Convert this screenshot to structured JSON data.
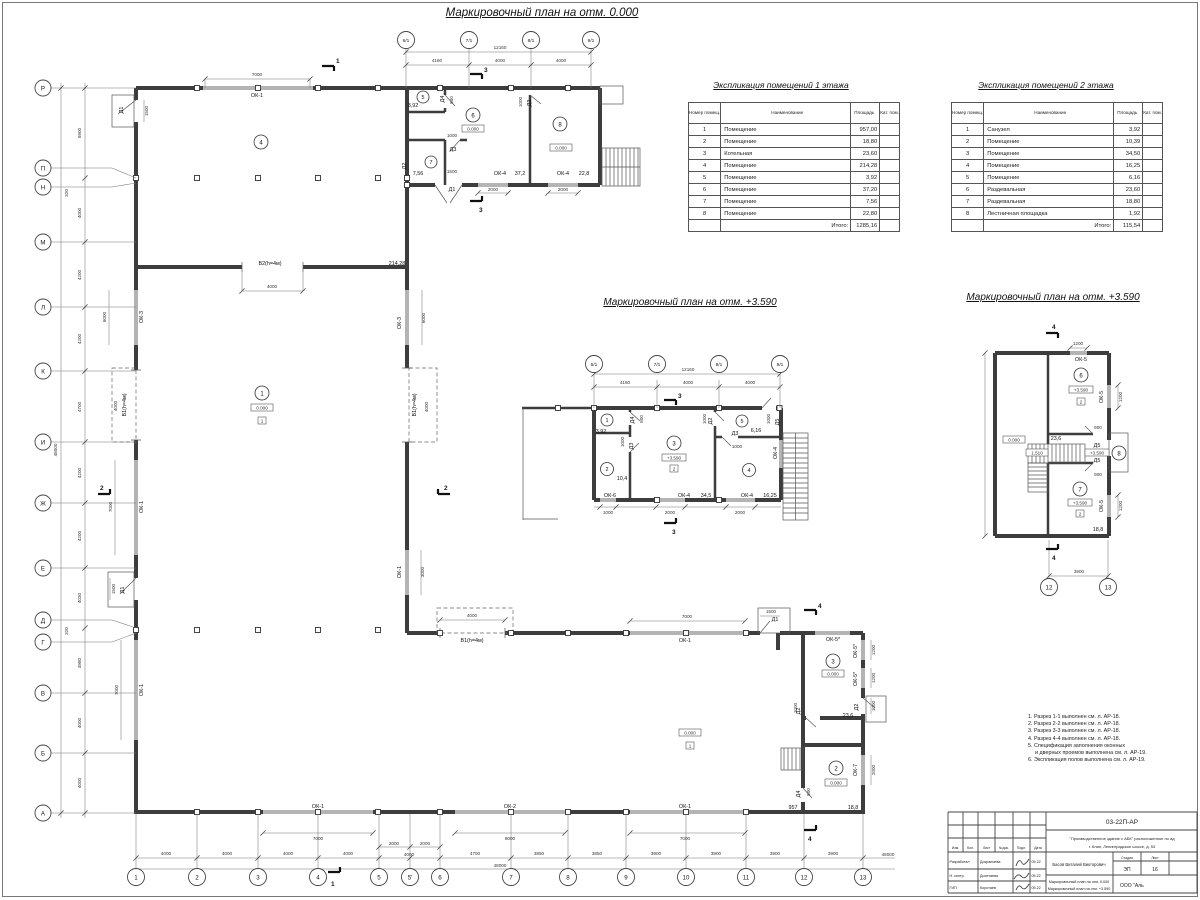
{
  "titles": {
    "plan0": "Маркировочный план на отм. 0.000",
    "plan359": "Маркировочный план на отм. +3.590"
  },
  "tables": {
    "floor1": {
      "title": "Экспликация помещений 1 этажа",
      "h_num": "Номер помещ.",
      "h_name": "Наименование",
      "h_area": "Площадь",
      "h_cat": "Кат. пом.",
      "rows": [
        {
          "n": "1",
          "name": "Помещение",
          "a": "957,00"
        },
        {
          "n": "2",
          "name": "Помещение",
          "a": "18,80"
        },
        {
          "n": "3",
          "name": "Котельная",
          "a": "23,60"
        },
        {
          "n": "4",
          "name": "Помещение",
          "a": "214,28"
        },
        {
          "n": "5",
          "name": "Помещение",
          "a": "3,92"
        },
        {
          "n": "6",
          "name": "Помещение",
          "a": "37,20"
        },
        {
          "n": "7",
          "name": "Помещение",
          "a": "7,56"
        },
        {
          "n": "8",
          "name": "Помещение",
          "a": "22,80"
        }
      ],
      "total_label": "Итого:",
      "total": "1285,16"
    },
    "floor2": {
      "title": "Экспликация помещений 2 этажа",
      "h_num": "Номер помещ.",
      "h_name": "Наименование",
      "h_area": "Площадь",
      "h_cat": "Кат. пом.",
      "rows": [
        {
          "n": "1",
          "name": "Санузел",
          "a": "3,92"
        },
        {
          "n": "2",
          "name": "Помещение",
          "a": "10,39"
        },
        {
          "n": "3",
          "name": "Помещение",
          "a": "34,50"
        },
        {
          "n": "4",
          "name": "Помещение",
          "a": "16,25"
        },
        {
          "n": "5",
          "name": "Помещение",
          "a": "6,16"
        },
        {
          "n": "6",
          "name": "Раздевальная",
          "a": "23,60"
        },
        {
          "n": "7",
          "name": "Раздевальная",
          "a": "18,80"
        },
        {
          "n": "8",
          "name": "Лестничная площадка",
          "a": "1,92"
        }
      ],
      "total_label": "Итого:",
      "total": "115,54"
    }
  },
  "notes": [
    "1. Разрез 1-1 выполнен см. л. АР-18.",
    "2. Разрез 2-2 выполнен см. л. АР-18.",
    "3. Разрез 3-3 выполнен см. л. АР-18.",
    "4. Разрез 4-4 выполнен см. л. АР-18.",
    "5. Спецификация заполнения оконных",
    "и дверных проемов выполнена см. л. АР-19.",
    "6. Экспликация полов выполнена см. л. АР-19."
  ],
  "stamp": {
    "code": "03-22П-АР",
    "object1": "\"Производственное здание с АБК\" расположенное по ад",
    "object2": "г. Клин, Ленинградское шоссе, д. 53",
    "c_izm": "Изм.",
    "c_kol": "Кол.",
    "c_list": "Лист",
    "c_ndok": "№док.",
    "c_podp": "Подл.",
    "c_data": "Дата",
    "r1_role": "Разработал",
    "r1_name": "Докраниева",
    "r1_date": "05.22",
    "r2_role": "Н. контр.",
    "r2_name": "Досетаева",
    "r2_date": "05.22",
    "r3_role": "ГИП",
    "r3_name": "Коротаев",
    "r3_date": "05.22",
    "gip_name": "Басов Виталий Викторович",
    "stage_l": "Стадия",
    "list_l": "Лист",
    "stage": "ЭП",
    "list": "16",
    "t1": "Маркировочный план на отм. 0.000",
    "t2": "Маркировочный план на отм. +3.590",
    "company": "ООО \"Аль"
  },
  "axes": {
    "left": [
      "Р",
      "П",
      "Н",
      "М",
      "Л",
      "К",
      "И",
      "Ж",
      "Е",
      "Д",
      "Г",
      "В",
      "Б",
      "А"
    ],
    "bottom": [
      "1",
      "2",
      "3",
      "4",
      "5",
      "5'",
      "6",
      "7",
      "8",
      "9",
      "10",
      "11",
      "12",
      "13"
    ],
    "top": [
      "6/1",
      "7/1",
      "8/1",
      "9/1"
    ],
    "rp": [
      "12",
      "13"
    ]
  },
  "dims": {
    "n320": "320",
    "n800": "800",
    "n900": "900",
    "n957": "957",
    "n1000": "1000",
    "n1200": "1200",
    "n1500": "1500",
    "n1510": "1,510",
    "n2000": "2000",
    "n3000": "3000",
    "n3850": "3850",
    "n3900": "3900",
    "n3980": "3980",
    "n4000": "4000",
    "n4030": "4030",
    "n4160": "4160",
    "n4200": "4200",
    "n4700": "4700",
    "n5900": "5900",
    "n6000": "6000",
    "n7000": "7000",
    "n8000": "8000",
    "n12160": "12160",
    "n48000": "48000"
  },
  "labels": {
    "ok1": "ОК-1",
    "ok2": "ОК-2",
    "ok3": "ОК-3",
    "ok4": "ОК-4",
    "ok5": "ОК-5",
    "ok5s": "ОК-5*",
    "ok6": "ОК-6",
    "ok7": "ОК-7",
    "d1": "Д1",
    "d2": "Д2",
    "d3": "Д3",
    "d4": "Д4",
    "d5": "Д5",
    "v1": "В1(h=4м)",
    "v2": "В2(h=4м)",
    "lvl0": "0.000",
    "lvl359": "+3.590",
    "fl1": "1",
    "fl2": "2",
    "r1": "1",
    "r2": "2",
    "r3": "3",
    "r4": "4",
    "r5": "5",
    "r6": "6",
    "r7": "7",
    "r8": "8",
    "s1": "1",
    "s2": "2",
    "s3": "3",
    "s4": "4",
    "a392": "3,92",
    "a756": "7,56",
    "a372": "37,2",
    "a228": "22,8",
    "a21428": "214,28",
    "a104": "10,4",
    "a345": "34,5",
    "a1625": "16,25",
    "a616": "6,16",
    "a236": "23,6",
    "a188": "18,8"
  }
}
